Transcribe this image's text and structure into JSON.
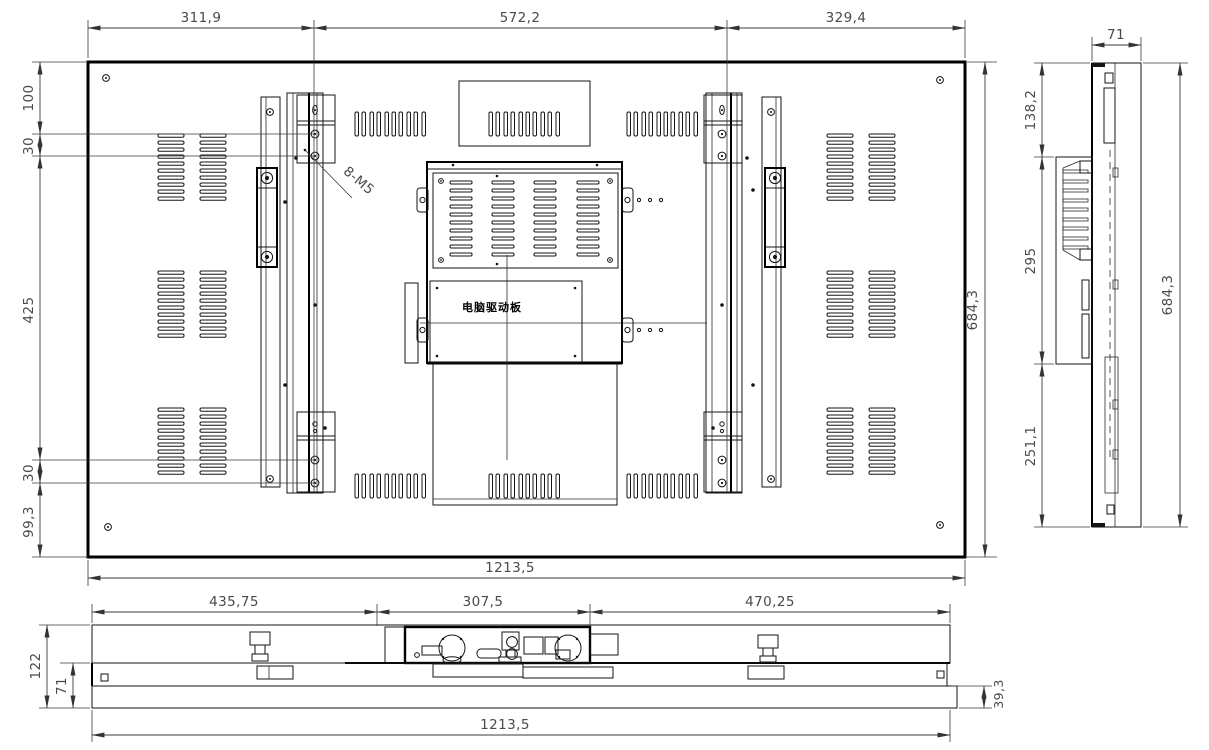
{
  "drawing_labels": {
    "board_label": "电脑驱动板",
    "thread_callout": "8-M5"
  },
  "views": {
    "rear": {
      "dims": {
        "top": [
          "311,9",
          "572,2",
          "329,4"
        ],
        "left": [
          "100",
          "30",
          "425",
          "30",
          "99,3"
        ],
        "right": "684,3",
        "bottom": "1213,5"
      }
    },
    "side": {
      "dims": {
        "top": "71",
        "left": [
          "138,2",
          "295",
          "251,1"
        ],
        "right": "684,3"
      }
    },
    "bottom": {
      "dims": {
        "top": [
          "435,75",
          "307,5",
          "470,25"
        ],
        "left": [
          "122",
          "71"
        ],
        "right": "39,3",
        "bottom": "1213,5"
      }
    }
  }
}
